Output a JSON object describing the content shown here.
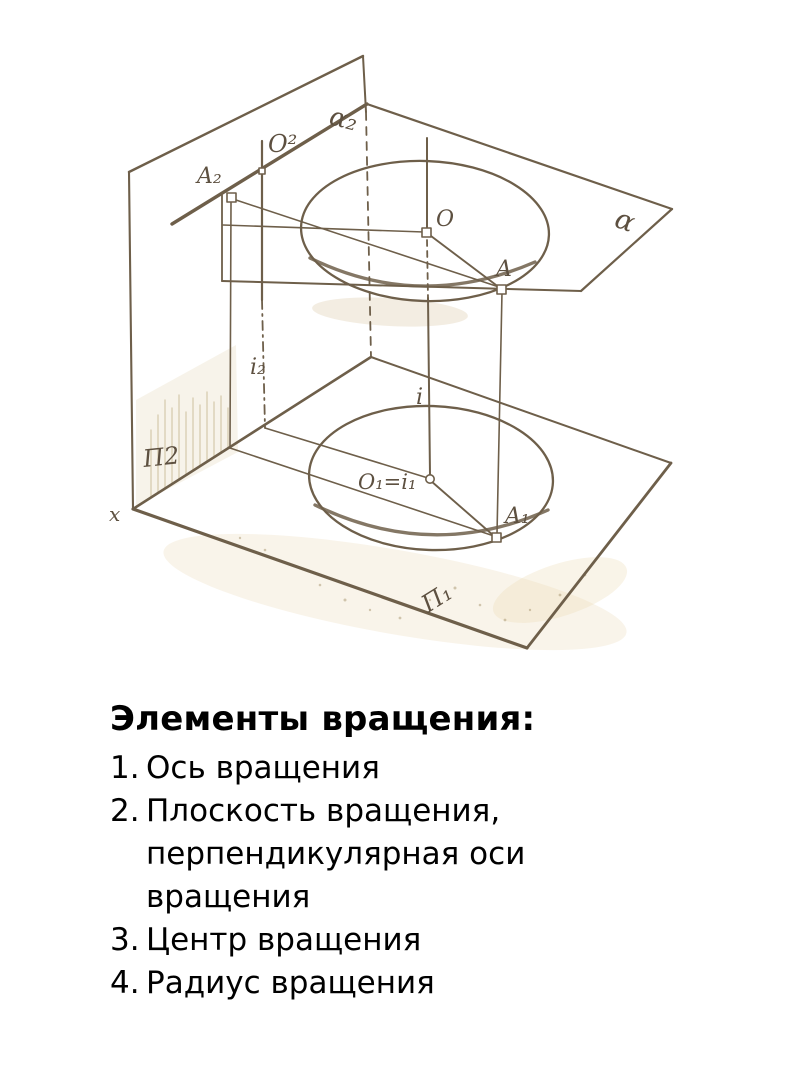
{
  "slide": {
    "heading": "Элементы вращения:",
    "items": [
      {
        "num": "1.",
        "text": "Ось вращения"
      },
      {
        "num": "2.",
        "text": "Плоскость вращения, перпендикулярная оси вращения"
      },
      {
        "num": "3.",
        "text": "Центр вращения"
      },
      {
        "num": "4.",
        "text": "Радиус вращения"
      }
    ]
  },
  "figure": {
    "description": "Scanned axonometric sketch: rotation of point A about vertical axis i, with projection planes П2 and П1, rotation plane α and circular path",
    "ink_color": "#6e5f4a",
    "labels": {
      "alpha2": "α₂",
      "o2": "O²",
      "a2": "A₂",
      "alpha": "α",
      "o": "O",
      "a": "A",
      "i2": "i₂",
      "i": "i",
      "o1i1": "O₁=i₁",
      "a1": "A₁",
      "p2": "П2",
      "p1": "П₁",
      "x": "x"
    }
  }
}
